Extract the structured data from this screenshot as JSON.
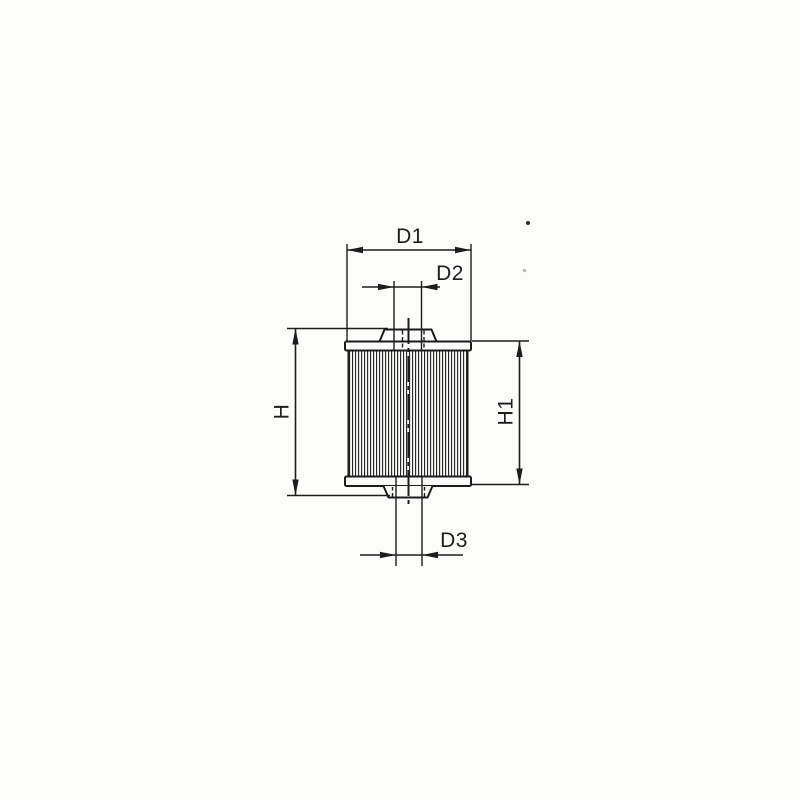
{
  "drawing": {
    "background_color": "#fcfcfb",
    "line_color": "#1c1c1c",
    "description_labels": [
      "D1",
      "D2",
      "D3",
      "H",
      "H1"
    ],
    "dimensions": {
      "d1": {
        "label": "D1"
      },
      "d2": {
        "label": "D2"
      },
      "d3": {
        "label": "D3"
      },
      "h": {
        "label": "H"
      },
      "h1": {
        "label": "H1"
      }
    }
  }
}
